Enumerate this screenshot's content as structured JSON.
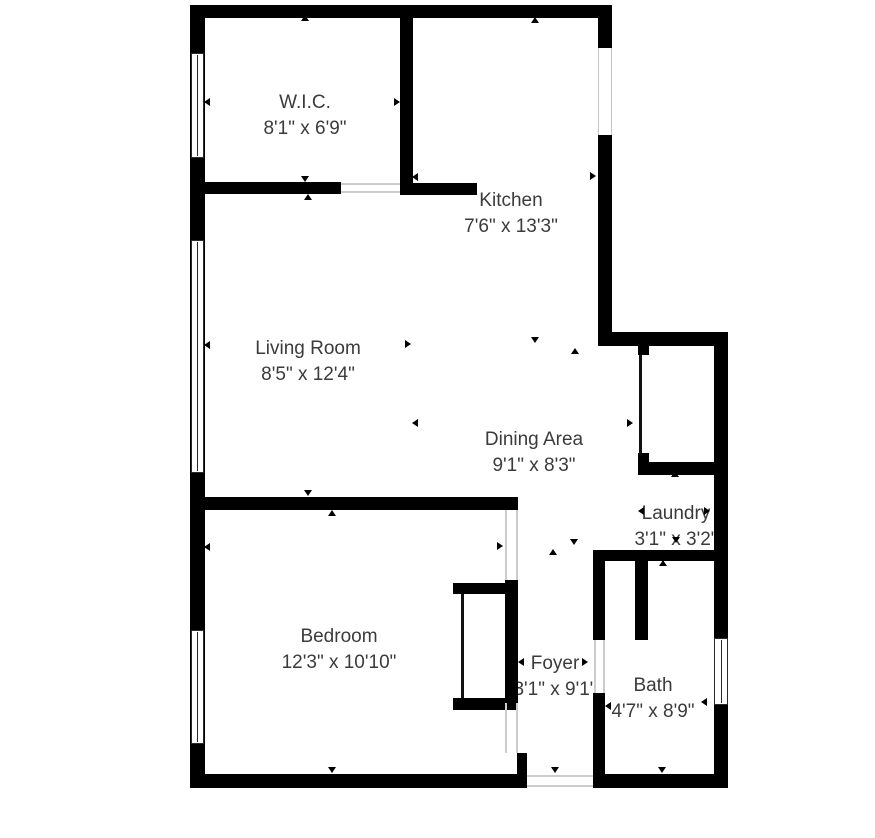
{
  "plan": {
    "type": "residential-floor-plan",
    "background_color": "#ffffff",
    "wall_color": "#000000",
    "label_color": "#3b3b3b",
    "marker": {
      "shape": "triangle",
      "color": "#000000"
    }
  },
  "rooms": {
    "wic": {
      "name": "W.I.C.",
      "dims": "8'1\" x 6'9\""
    },
    "kitchen": {
      "name": "Kitchen",
      "dims": "7'6\" x 13'3\""
    },
    "living": {
      "name": "Living Room",
      "dims": "8'5\" x 12'4\""
    },
    "dining": {
      "name": "Dining Area",
      "dims": "9'1\" x 8'3\""
    },
    "laundry": {
      "name": "Laundry",
      "dims": "3'1\" x 3'2\""
    },
    "bedroom": {
      "name": "Bedroom",
      "dims": "12'3\" x 10'10\""
    },
    "foyer": {
      "name": "Foyer",
      "dims": "3'1\" x 9'1\""
    },
    "bath": {
      "name": "Bath",
      "dims": "4'7\" x 8'9\""
    }
  }
}
